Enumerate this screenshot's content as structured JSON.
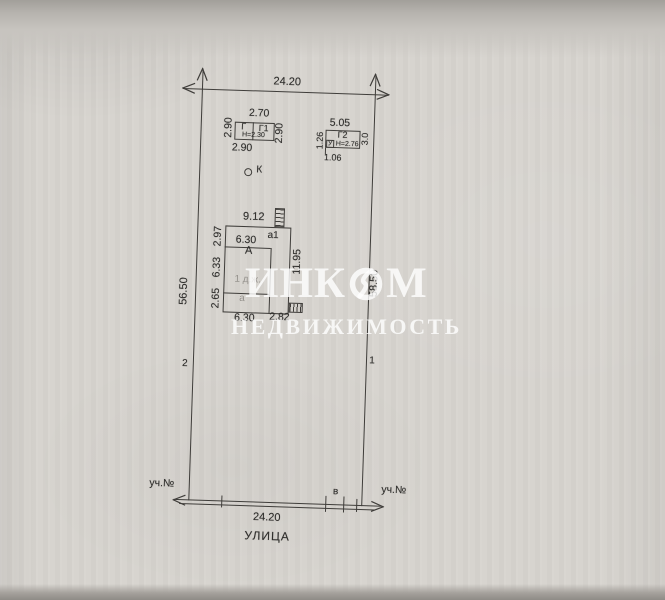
{
  "colors": {
    "paper": "#d7d4cf",
    "ink": "#3f3d3a",
    "faded_ink": "#95928d",
    "watermark": "#ffffff"
  },
  "watermark": {
    "brand_left": "ИНК",
    "brand_right": "М",
    "logo": "lightning-ring-logo",
    "subtitle": "НЕДВИЖИМОСТЬ"
  },
  "plot": {
    "top_width": "24.20",
    "left_length": "56.50",
    "right_length": "58.50",
    "left_point": "2",
    "right_point": "1"
  },
  "street": {
    "width": "24.20",
    "name": "УЛИЦА",
    "neighbor_left": "уч.№",
    "neighbor_right": "уч.№",
    "gate": "в"
  },
  "shed_g": {
    "cell_left": "Г",
    "cell_right": "Г1",
    "height": "Н=2.30",
    "dim_top": "2.70",
    "dim_left": "2.90",
    "dim_right": "2.90",
    "dim_bottom": "2.90"
  },
  "shed_g2": {
    "name": "Г2",
    "annex": "У",
    "height": "Н=2.76",
    "dim_top": "5.05",
    "dim_left": "1.26",
    "dim_right": "3.0",
    "dim_bottom": "1.06"
  },
  "well": {
    "name": "К"
  },
  "house": {
    "main": "А",
    "annex_top": "а1",
    "annex_bottom": "а",
    "use": "1 д.ж.",
    "dim_top": "9.12",
    "dim_inner_top": "6.30",
    "dim_left_upper": "2.97",
    "dim_left_middle": "6.33",
    "dim_left_lower": "2.65",
    "dim_right": "11.95",
    "dim_bottom_left": "6.30",
    "dim_bottom_right": "2.82"
  }
}
